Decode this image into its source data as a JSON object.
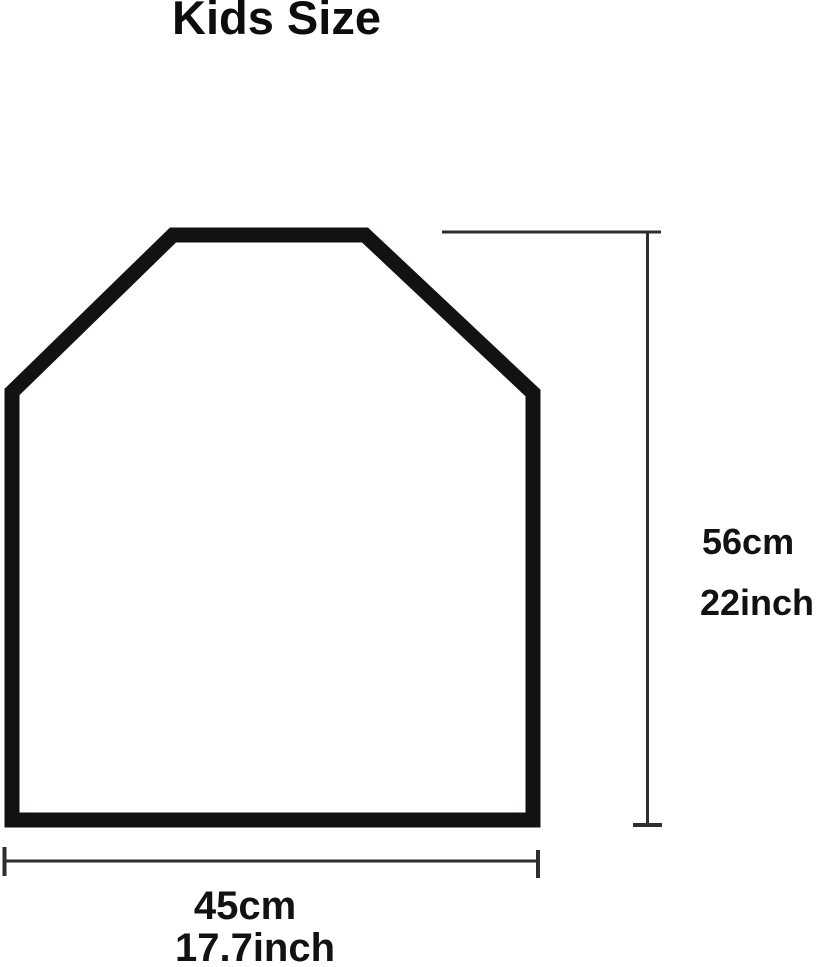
{
  "title": "Kids Size",
  "size_diagram": {
    "subject": "kids-garment-cover-outline",
    "height": {
      "cm": "56cm",
      "inch": "22inch"
    },
    "width": {
      "cm": "45cm",
      "inch": "17.7inch"
    }
  },
  "colors": {
    "background": "#ffffff",
    "outline": "#141115",
    "dimension_line": "#2e2e2e",
    "label_text": "#121212"
  }
}
